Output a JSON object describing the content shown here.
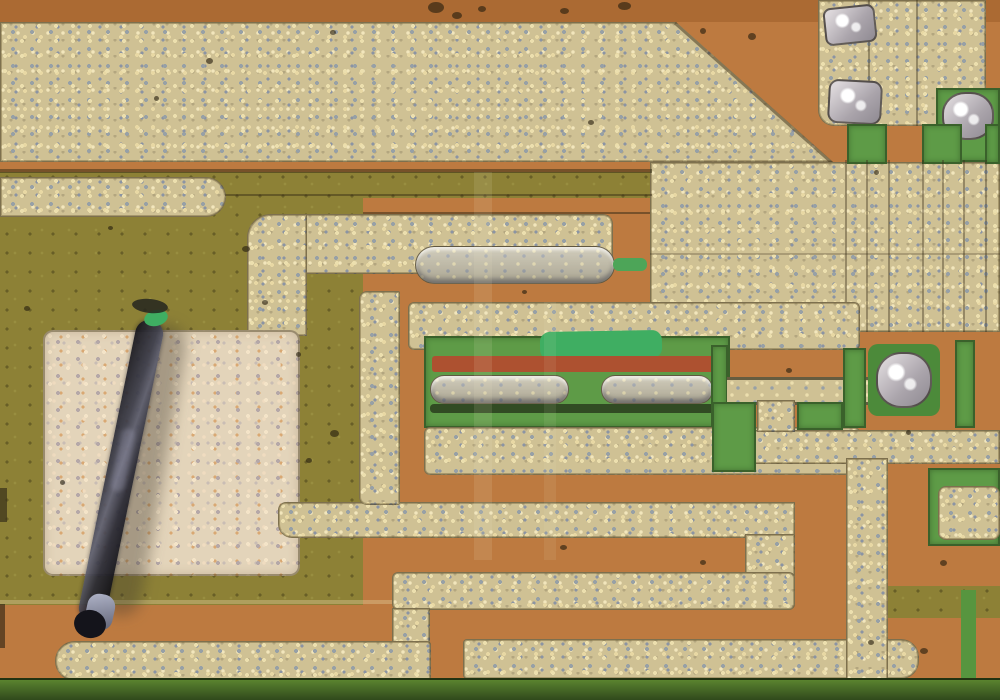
{
  "scene": {
    "description": "optical micrograph of an integrated circuit die: orange oxide background, speckled gold metal interconnect traces, olive and green diffusion regions, a dark dust fiber lying on a pale metal pad, silvery probe-mark blobs",
    "width": 1000,
    "height": 700,
    "palette": {
      "orange": "#bd7a40",
      "orange_dark": "#ab6a33",
      "metal": "#cfc194",
      "metal_pale": "#e3d4ba",
      "olive": "#8d8136",
      "green": "#5e9b47",
      "green_bright": "#3fae62",
      "green_deep": "#4c8a3a",
      "silver": "#cac4c8",
      "red_strip": "#ad5130",
      "bottom_green_1": "#5a832f",
      "bottom_green_2": "#30491c",
      "fiber_dark": "#16161d",
      "hairline": "rgba(55,45,25,0.38)"
    },
    "regions": [
      {
        "n": "top-oxide-strip",
        "t": "flat",
        "x": 0,
        "y": 0,
        "w": 1000,
        "h": 22,
        "bg": "#ab6a33"
      },
      {
        "n": "olive-left-field",
        "t": "olive",
        "x": 0,
        "y": 172,
        "w": 363,
        "h": 433
      },
      {
        "n": "olive-mid-strip",
        "t": "olive",
        "x": 363,
        "y": 172,
        "w": 287,
        "h": 26
      },
      {
        "n": "metal-top-plane",
        "t": "metal",
        "x": 0,
        "y": 22,
        "w": 833,
        "h": 140
      },
      {
        "n": "oxide-diagonal-notch",
        "t": "flat",
        "x": 676,
        "y": 22,
        "w": 158,
        "h": 141,
        "bg": "#bd7a40",
        "clip": "polygon(0 0,100% 0,100% 100%)"
      },
      {
        "n": "oxide-right-upper",
        "t": "flat",
        "x": 833,
        "y": 22,
        "w": 167,
        "h": 141,
        "bg": "#bd7a40"
      },
      {
        "n": "diagonal-edge-line",
        "t": "flat",
        "x": 676,
        "y": 22,
        "w": 212,
        "h": 3,
        "bg": "rgba(60,45,22,.5)",
        "rot": 41.7,
        "org": "0 0"
      },
      {
        "n": "metal-right-plane",
        "t": "metal",
        "x": 650,
        "y": 162,
        "w": 350,
        "h": 170
      },
      {
        "n": "plane-boundary-line",
        "t": "flat",
        "x": 0,
        "y": 169,
        "w": 652,
        "h": 4,
        "bg": "rgba(48,40,18,.5)"
      },
      {
        "n": "bond-pad-top-right",
        "t": "metal",
        "x": 818,
        "y": 0,
        "w": 168,
        "h": 126,
        "r": "0 0 12px 16px"
      },
      {
        "n": "pad-hairline-1",
        "t": "flat",
        "x": 868,
        "y": 0,
        "w": 2,
        "h": 126,
        "bg": "rgba(60,50,28,.4)"
      },
      {
        "n": "pad-hairline-2",
        "t": "flat",
        "x": 916,
        "y": 0,
        "w": 2,
        "h": 126,
        "bg": "rgba(60,50,28,.4)"
      },
      {
        "n": "probe-mark-1",
        "t": "silver",
        "x": 824,
        "y": 6,
        "w": 52,
        "h": 38,
        "r": "8px",
        "rot": -6
      },
      {
        "n": "probe-mark-2",
        "t": "silver",
        "x": 828,
        "y": 80,
        "w": 54,
        "h": 44,
        "r": "10px",
        "rot": 3
      },
      {
        "n": "green-well-top-right",
        "t": "green",
        "x": 936,
        "y": 88,
        "w": 64,
        "h": 74
      },
      {
        "n": "probe-blob-top-right",
        "t": "silver",
        "x": 942,
        "y": 92,
        "w": 52,
        "h": 48,
        "r": "45%"
      },
      {
        "n": "green-contact-1",
        "t": "green",
        "x": 847,
        "y": 124,
        "w": 40,
        "h": 40
      },
      {
        "n": "green-contact-2",
        "t": "green",
        "x": 922,
        "y": 124,
        "w": 40,
        "h": 40
      },
      {
        "n": "green-contact-3",
        "t": "green",
        "x": 985,
        "y": 124,
        "w": 15,
        "h": 40
      },
      {
        "n": "buried-line-1",
        "t": "flat",
        "x": 845,
        "y": 160,
        "w": 2,
        "h": 172,
        "bg": "rgba(55,45,25,.38)"
      },
      {
        "n": "buried-line-2",
        "t": "flat",
        "x": 866,
        "y": 160,
        "w": 2,
        "h": 172,
        "bg": "rgba(55,45,25,.38)"
      },
      {
        "n": "buried-line-3",
        "t": "flat",
        "x": 888,
        "y": 160,
        "w": 2,
        "h": 172,
        "bg": "rgba(55,45,25,.38)"
      },
      {
        "n": "buried-line-4",
        "t": "flat",
        "x": 922,
        "y": 160,
        "w": 2,
        "h": 172,
        "bg": "rgba(55,45,25,.38)"
      },
      {
        "n": "buried-line-5",
        "t": "flat",
        "x": 942,
        "y": 160,
        "w": 2,
        "h": 172,
        "bg": "rgba(55,45,25,.38)"
      },
      {
        "n": "buried-line-6",
        "t": "flat",
        "x": 963,
        "y": 160,
        "w": 2,
        "h": 172,
        "bg": "rgba(55,45,25,.38)"
      },
      {
        "n": "buried-line-7",
        "t": "flat",
        "x": 985,
        "y": 160,
        "w": 2,
        "h": 172,
        "bg": "rgba(55,45,25,.38)"
      },
      {
        "n": "buried-line-h",
        "t": "flat",
        "x": 650,
        "y": 253,
        "w": 350,
        "h": 2,
        "bg": "rgba(55,45,25,.25)"
      },
      {
        "n": "metal-bar-top-left",
        "t": "metal",
        "x": 0,
        "y": 177,
        "w": 226,
        "h": 40,
        "r": "0 20px 20px 0"
      },
      {
        "n": "strip-hairline-1",
        "t": "flat",
        "x": 225,
        "y": 194,
        "w": 427,
        "h": 2,
        "bg": "rgba(50,40,20,.45)"
      },
      {
        "n": "strip-hairline-2",
        "t": "flat",
        "x": 363,
        "y": 212,
        "w": 287,
        "h": 2,
        "bg": "rgba(50,40,20,.5)"
      },
      {
        "n": "serpentine-top-arm",
        "t": "metal",
        "x": 247,
        "y": 214,
        "w": 366,
        "h": 60,
        "r": "24px 10px 10px 4px"
      },
      {
        "n": "serpentine-top-finger",
        "t": "emboss",
        "x": 415,
        "y": 246,
        "w": 200,
        "h": 38,
        "r": "19px"
      },
      {
        "n": "green-sliver",
        "t": "flat",
        "x": 613,
        "y": 258,
        "w": 34,
        "h": 13,
        "bg": "#4da558",
        "r": "6px"
      },
      {
        "n": "serpentine-left-leg",
        "t": "metal",
        "x": 247,
        "y": 214,
        "w": 60,
        "h": 122,
        "r": "24px 0 0 0"
      },
      {
        "n": "pale-bond-pad",
        "t": "metal-pale",
        "x": 43,
        "y": 330,
        "w": 257,
        "h": 246,
        "r": "10px"
      },
      {
        "n": "serpentine-band-2",
        "t": "metal",
        "x": 278,
        "y": 502,
        "w": 517,
        "h": 36,
        "r": "8px 0 0 14px"
      },
      {
        "n": "serpentine-elbow",
        "t": "metal",
        "x": 745,
        "y": 534,
        "w": 50,
        "h": 42
      },
      {
        "n": "serpentine-band-3",
        "t": "metal",
        "x": 392,
        "y": 572,
        "w": 403,
        "h": 38,
        "r": "6px"
      },
      {
        "n": "serpentine-band3-leg",
        "t": "metal",
        "x": 392,
        "y": 608,
        "w": 38,
        "h": 38
      },
      {
        "n": "metal-bar-bottom-left",
        "t": "metal",
        "x": 55,
        "y": 641,
        "w": 376,
        "h": 40,
        "r": "20px 4px 4px 20px"
      },
      {
        "n": "metal-bar-bottom-right",
        "t": "metal",
        "x": 463,
        "y": 639,
        "w": 456,
        "h": 40,
        "r": "4px 18px 18px 4px"
      },
      {
        "n": "transistor-frame-top",
        "t": "metal",
        "x": 408,
        "y": 302,
        "w": 452,
        "h": 48,
        "r": "6px"
      },
      {
        "n": "transistor-frame-left",
        "t": "metal",
        "x": 359,
        "y": 291,
        "w": 41,
        "h": 214,
        "r": "8px 2px 2px 8px"
      },
      {
        "n": "active-region-green",
        "t": "green",
        "x": 424,
        "y": 336,
        "w": 306,
        "h": 92
      },
      {
        "n": "emerald-patch",
        "t": "flat",
        "x": 540,
        "y": 331,
        "w": 122,
        "h": 28,
        "bg": "#3fae62",
        "r": "10px",
        "rot": -1
      },
      {
        "n": "base-red-strip",
        "t": "flat",
        "x": 432,
        "y": 356,
        "w": 292,
        "h": 16,
        "bg": "#ad5130",
        "r": "3px"
      },
      {
        "n": "emitter-finger-a",
        "t": "emboss",
        "x": 430,
        "y": 375,
        "w": 139,
        "h": 29,
        "r": "14px"
      },
      {
        "n": "emitter-finger-b",
        "t": "emboss",
        "x": 601,
        "y": 375,
        "w": 112,
        "h": 29,
        "r": "14px"
      },
      {
        "n": "finger-shadow",
        "t": "flat",
        "x": 430,
        "y": 404,
        "w": 294,
        "h": 9,
        "bg": "rgba(20,22,12,.6)",
        "r": "4px"
      },
      {
        "n": "green-strip-right-of-active",
        "t": "green",
        "x": 711,
        "y": 345,
        "w": 17,
        "h": 125
      },
      {
        "n": "transistor-frame-bottom",
        "t": "metal",
        "x": 424,
        "y": 427,
        "w": 436,
        "h": 48,
        "r": "6px"
      },
      {
        "n": "metal-band1-right",
        "t": "metal",
        "x": 728,
        "y": 430,
        "w": 272,
        "h": 34
      },
      {
        "n": "thin-interconnect-trace",
        "t": "trace",
        "x": 727,
        "y": 377,
        "w": 152,
        "h": 28
      },
      {
        "n": "trace-stub",
        "t": "metal",
        "x": 757,
        "y": 400,
        "w": 38,
        "h": 32
      },
      {
        "n": "green-square-a",
        "t": "green",
        "x": 712,
        "y": 402,
        "w": 44,
        "h": 70
      },
      {
        "n": "green-square-b",
        "t": "green",
        "x": 797,
        "y": 402,
        "w": 46,
        "h": 28
      },
      {
        "n": "contact-well-green",
        "t": "flat",
        "x": 868,
        "y": 344,
        "w": 72,
        "h": 72,
        "bg": "#4c8a3a",
        "r": "10px"
      },
      {
        "n": "probe-blob-center",
        "t": "silver",
        "x": 876,
        "y": 352,
        "w": 56,
        "h": 56,
        "r": "45%"
      },
      {
        "n": "green-column-1",
        "t": "green",
        "x": 843,
        "y": 348,
        "w": 23,
        "h": 80
      },
      {
        "n": "green-column-2",
        "t": "green",
        "x": 955,
        "y": 340,
        "w": 20,
        "h": 88
      },
      {
        "n": "metal-leg-right",
        "t": "metal",
        "x": 846,
        "y": 458,
        "w": 42,
        "h": 226
      },
      {
        "n": "green-well-right",
        "t": "green",
        "x": 928,
        "y": 468,
        "w": 72,
        "h": 78
      },
      {
        "n": "contact-pad-right",
        "t": "metal",
        "x": 938,
        "y": 486,
        "w": 62,
        "h": 54,
        "r": "8px"
      },
      {
        "n": "olive-strip-right",
        "t": "olive",
        "x": 888,
        "y": 586,
        "w": 112,
        "h": 32
      },
      {
        "n": "green-line-right",
        "t": "flat",
        "x": 961,
        "y": 590,
        "w": 15,
        "h": 92,
        "bg": "#57953f"
      },
      {
        "n": "bottom-diffusion-strip",
        "t": "bottom-strip",
        "x": 0,
        "y": 678,
        "w": 1000,
        "h": 22
      },
      {
        "n": "thin-tan-hairline",
        "t": "flat",
        "x": 0,
        "y": 600,
        "w": 392,
        "h": 4,
        "bg": "rgba(225,205,155,.4)"
      },
      {
        "n": "dark-edge-mark-1",
        "t": "flat",
        "x": 0,
        "y": 604,
        "w": 5,
        "h": 44,
        "bg": "rgba(40,32,18,.6)"
      },
      {
        "n": "dark-edge-mark-2",
        "t": "flat",
        "x": 0,
        "y": 488,
        "w": 7,
        "h": 34,
        "bg": "rgba(55,48,26,.7)"
      },
      {
        "n": "poly-overlay-band-1",
        "t": "flat",
        "x": 474,
        "y": 172,
        "w": 18,
        "h": 388,
        "bg": "rgba(238,228,200,.12)"
      },
      {
        "n": "poly-overlay-band-2",
        "t": "flat",
        "x": 544,
        "y": 302,
        "w": 12,
        "h": 258,
        "bg": "rgba(238,228,200,.09)"
      },
      {
        "n": "fiber-shadow",
        "t": "flat",
        "x": 122,
        "y": 322,
        "w": 42,
        "h": 296,
        "bg": "rgba(66,58,44,.38)",
        "rot": 10,
        "r": "22px",
        "blur": 7
      },
      {
        "n": "dust-fiber",
        "t": "fiber",
        "x": 107,
        "y": 317,
        "w": 28,
        "h": 308,
        "rot": 11.6
      },
      {
        "n": "fiber-sheen",
        "t": "flat",
        "x": 116,
        "y": 428,
        "w": 14,
        "h": 64,
        "bg": "rgba(165,165,190,.28)",
        "rot": 11.6,
        "r": "7px",
        "blur": 2
      },
      {
        "n": "fiber-tip-highlight",
        "t": "glint",
        "x": 86,
        "y": 594,
        "w": 28,
        "h": 36,
        "rot": 12
      },
      {
        "n": "fiber-tip-dark",
        "t": "flat",
        "x": 74,
        "y": 610,
        "w": 32,
        "h": 28,
        "bg": "#14141b",
        "r": "50%",
        "rot": 12
      },
      {
        "n": "fiber-green-speck",
        "t": "flat",
        "x": 144,
        "y": 310,
        "w": 24,
        "h": 16,
        "bg": "#3fae62",
        "r": "50%",
        "rot": -14
      },
      {
        "n": "fiber-dark-wisp",
        "t": "flat",
        "x": 132,
        "y": 299,
        "w": 36,
        "h": 14,
        "bg": "rgba(36,38,30,.85)",
        "r": "50%",
        "rot": 6
      },
      {
        "n": "dust-dot",
        "t": "dot",
        "x": 428,
        "y": 2,
        "w": 16,
        "h": 11
      },
      {
        "n": "dust-dot",
        "t": "dot",
        "x": 452,
        "y": 12,
        "w": 10,
        "h": 7
      },
      {
        "n": "dust-dot",
        "t": "dot",
        "x": 478,
        "y": 6,
        "w": 8,
        "h": 6
      },
      {
        "n": "dust-dot",
        "t": "dot",
        "x": 560,
        "y": 8,
        "w": 9,
        "h": 6
      },
      {
        "n": "dust-dot",
        "t": "dot",
        "x": 618,
        "y": 2,
        "w": 13,
        "h": 8
      },
      {
        "n": "dust-dot",
        "t": "dot",
        "x": 700,
        "y": 28,
        "w": 6,
        "h": 6
      },
      {
        "n": "dust-dot",
        "t": "dot",
        "x": 748,
        "y": 33,
        "w": 8,
        "h": 7
      },
      {
        "n": "dust-dot",
        "t": "dot",
        "x": 206,
        "y": 58,
        "w": 7,
        "h": 6
      },
      {
        "n": "dust-dot",
        "t": "dot",
        "x": 154,
        "y": 96,
        "w": 5,
        "h": 5
      },
      {
        "n": "dust-dot",
        "t": "dot",
        "x": 330,
        "y": 30,
        "w": 6,
        "h": 5
      },
      {
        "n": "dust-dot",
        "t": "dot",
        "x": 588,
        "y": 120,
        "w": 6,
        "h": 5
      },
      {
        "n": "dust-dot",
        "t": "dot",
        "x": 874,
        "y": 170,
        "w": 5,
        "h": 5
      },
      {
        "n": "dust-dot",
        "t": "dot",
        "x": 242,
        "y": 246,
        "w": 8,
        "h": 6
      },
      {
        "n": "dust-dot",
        "t": "dot",
        "x": 262,
        "y": 300,
        "w": 6,
        "h": 5
      },
      {
        "n": "dust-dot",
        "t": "dot",
        "x": 296,
        "y": 352,
        "w": 5,
        "h": 5
      },
      {
        "n": "dust-dot",
        "t": "dot",
        "x": 108,
        "y": 226,
        "w": 5,
        "h": 4
      },
      {
        "n": "dust-dot",
        "t": "dot",
        "x": 24,
        "y": 306,
        "w": 6,
        "h": 5
      },
      {
        "n": "dust-dot",
        "t": "dot",
        "x": 330,
        "y": 430,
        "w": 9,
        "h": 7
      },
      {
        "n": "dust-dot",
        "t": "dot",
        "x": 306,
        "y": 458,
        "w": 6,
        "h": 5
      },
      {
        "n": "dust-dot",
        "t": "dot",
        "x": 60,
        "y": 480,
        "w": 5,
        "h": 5
      },
      {
        "n": "dust-dot",
        "t": "dot",
        "x": 522,
        "y": 290,
        "w": 5,
        "h": 4
      },
      {
        "n": "dust-dot",
        "t": "dot",
        "x": 786,
        "y": 368,
        "w": 6,
        "h": 5
      },
      {
        "n": "dust-dot",
        "t": "dot",
        "x": 560,
        "y": 545,
        "w": 7,
        "h": 5
      },
      {
        "n": "dust-dot",
        "t": "dot",
        "x": 700,
        "y": 560,
        "w": 6,
        "h": 5
      },
      {
        "n": "dust-dot",
        "t": "dot",
        "x": 906,
        "y": 430,
        "w": 5,
        "h": 5
      },
      {
        "n": "dust-dot",
        "t": "dot",
        "x": 940,
        "y": 560,
        "w": 7,
        "h": 6
      },
      {
        "n": "dust-dot",
        "t": "dot",
        "x": 868,
        "y": 640,
        "w": 6,
        "h": 5
      },
      {
        "n": "dust-dot",
        "t": "dot",
        "x": 920,
        "y": 648,
        "w": 8,
        "h": 6
      }
    ]
  }
}
